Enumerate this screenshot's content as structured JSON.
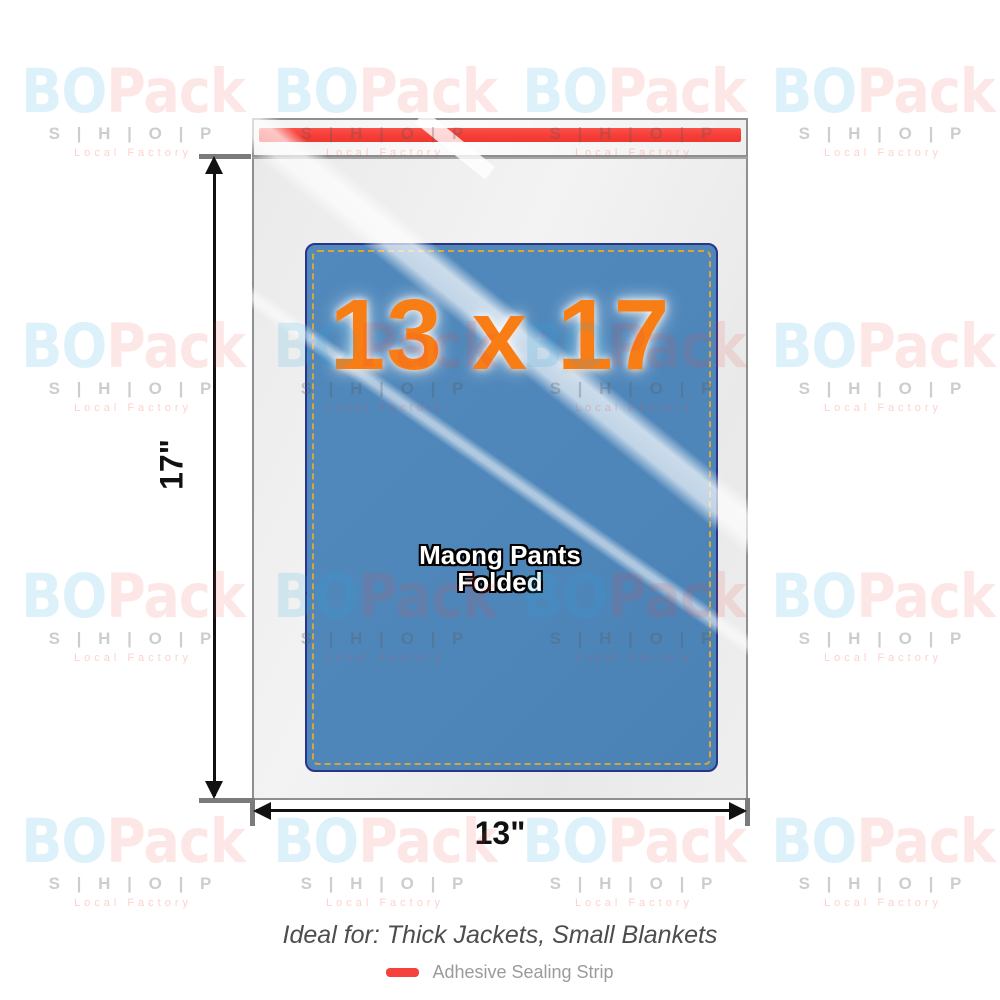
{
  "watermark": {
    "bo": "BO",
    "pack": "Pack",
    "shop": "S | H | O | P",
    "tagline": "Local Factory"
  },
  "bag": {
    "size_label": "13 x 17",
    "content_line1": "Maong Pants",
    "content_line2": "Folded"
  },
  "dimensions": {
    "height_label": "17\"",
    "width_label": "13\""
  },
  "footer": {
    "ideal_text": "Ideal for: Thick Jackets, Small Blankets",
    "legend_label": "Adhesive Sealing Strip"
  },
  "colors": {
    "adhesive_strip_red": "#f6413c",
    "contents_blue": "#4e86ba",
    "contents_border_navy": "#2a3585",
    "stitch_gold": "#d9a43c",
    "size_text_orange": "#f97d15",
    "watermark_blue": "#29abe2",
    "watermark_red": "#f1463c"
  }
}
